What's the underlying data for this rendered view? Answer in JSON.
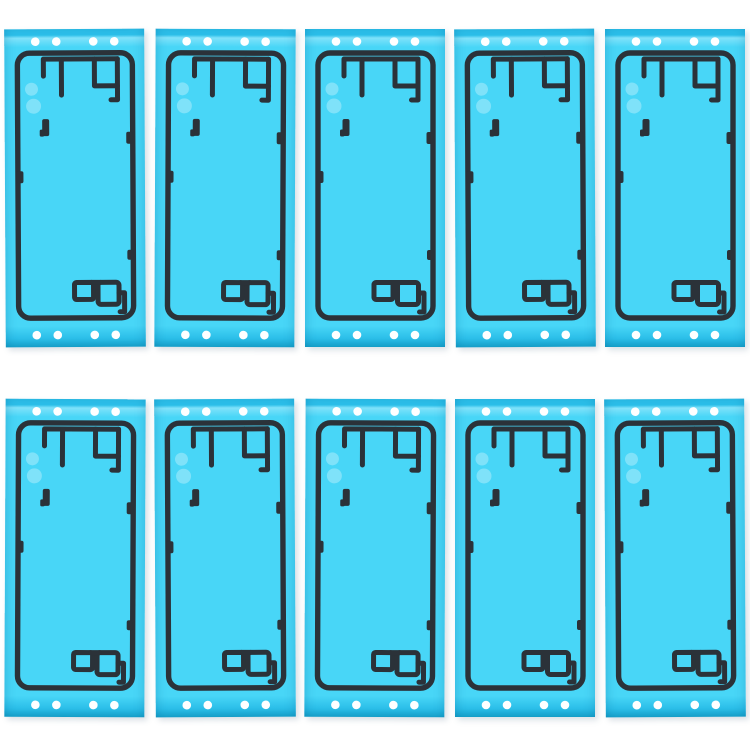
{
  "page": {
    "background_color": "#ffffff",
    "description": "Grid of 10 identical cyan phone back-housing adhesive sticker sheets, 5 columns by 2 rows, each sheet with white perforation dots along top and bottom edges and a dark adhesive outline pattern"
  },
  "grid": {
    "rows": 2,
    "columns": 5,
    "item_count": 10
  },
  "sticker": {
    "label": "back-cover-adhesive-sheet",
    "width_px": 140,
    "height_px": 318,
    "colors": {
      "base": "#48d6f7",
      "band": "#2cbfe9",
      "band_light": "#7fe2fa",
      "edge_dark": "#17a3cc",
      "outline": "#2b3239",
      "dot": "#ffffff",
      "reflection": "rgba(255,255,255,0.30)",
      "background": "#ffffff"
    },
    "perforations": {
      "per_edge": 2,
      "rows": [
        "top",
        "bottom"
      ],
      "dots_per_row": 4,
      "x_px": [
        31,
        52,
        89,
        110
      ],
      "top_cy": 12.5,
      "bottom_cy": 306,
      "radius_px": 4.3
    }
  }
}
